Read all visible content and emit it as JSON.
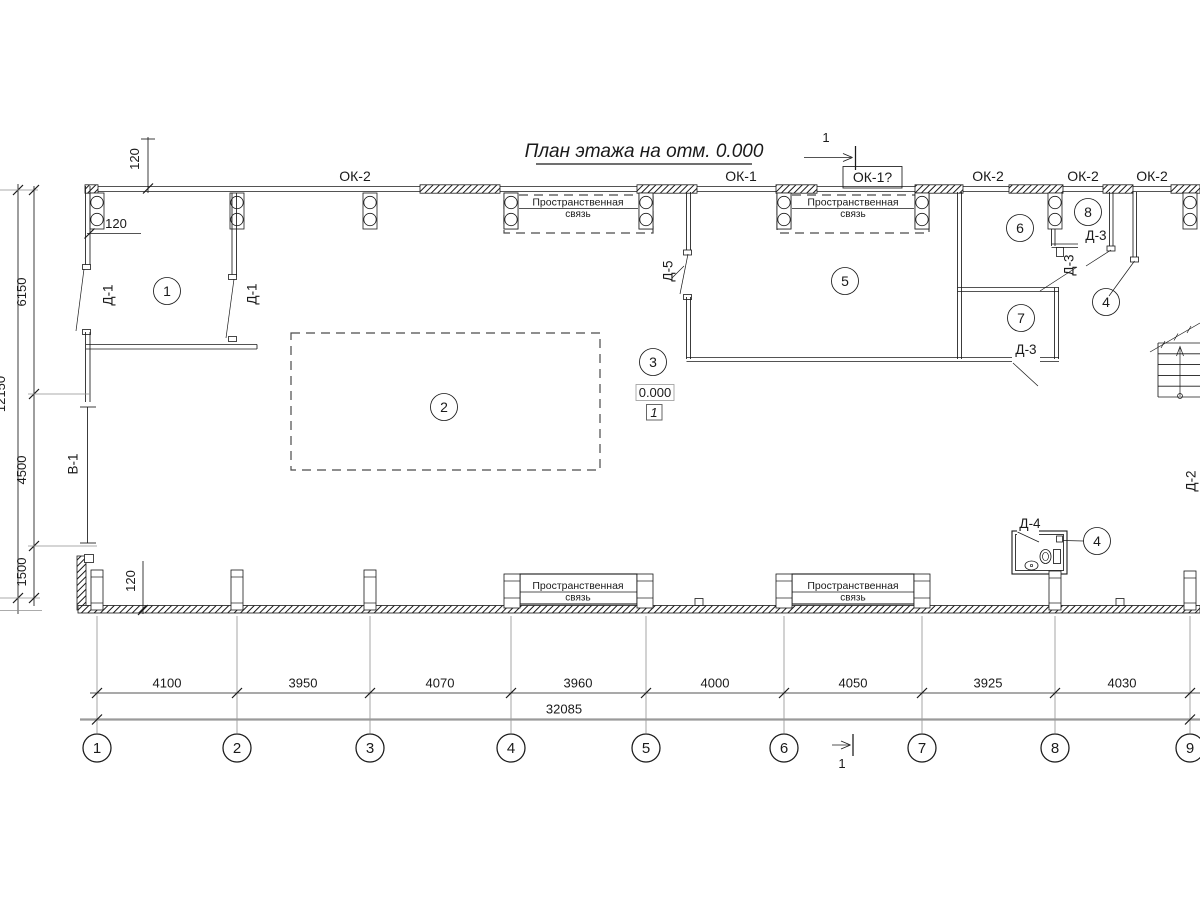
{
  "title": {
    "text": "План этажа на отм. 0.000"
  },
  "windows": {
    "ok2": "ОК-2",
    "ok1": "ОК-1",
    "ok1_alt": "ОК-1?"
  },
  "spatial_tie": {
    "line1": "Пространственная",
    "line2": "связь"
  },
  "rooms": {
    "r1": "1",
    "r2": "2",
    "r3": "3",
    "r4": "4",
    "r5": "5",
    "r6": "6",
    "r7": "7",
    "r8": "8"
  },
  "doors": {
    "d1": "Д-1",
    "d2": "Д-2",
    "d3": "Д-3",
    "d4": "Д-4",
    "d5": "Д-5",
    "gate": "В-1"
  },
  "elevation": {
    "value": "0.000",
    "node": "1"
  },
  "section": {
    "label": "1"
  },
  "axes": [
    "1",
    "2",
    "3",
    "4",
    "5",
    "6",
    "7",
    "8",
    "9"
  ],
  "dims": {
    "bottom": [
      "4100",
      "3950",
      "4070",
      "3960",
      "4000",
      "4050",
      "3925",
      "4030"
    ],
    "bottom_total": "32085",
    "left": [
      "6150",
      "4500",
      "1500"
    ],
    "left_total": "12150",
    "wall": "120"
  },
  "colors": {
    "line": "#1a1a1a",
    "grid": "#8f8f8f"
  }
}
